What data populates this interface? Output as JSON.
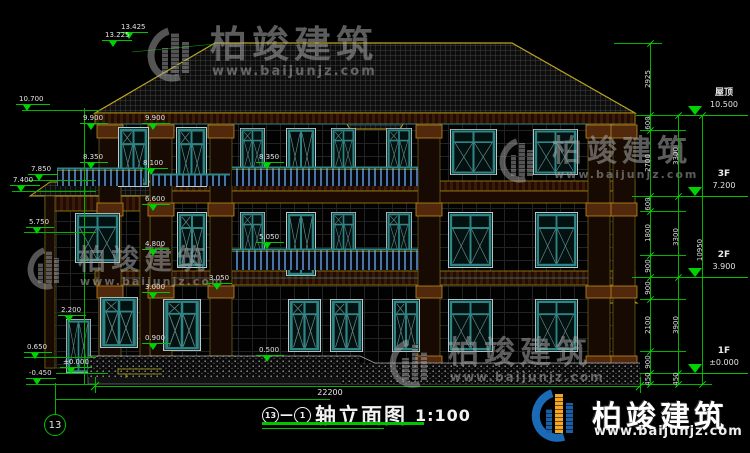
{
  "drawing_title": {
    "start_axis": "13",
    "end_axis": "1",
    "name": "轴立面图",
    "scale": "1:100"
  },
  "axis_bubble": {
    "label": "13"
  },
  "brand": {
    "name": "柏竣建筑",
    "url": "www.baijunjz.com"
  },
  "bottom_dimension": {
    "value": "22200"
  },
  "floor_levels": [
    {
      "name": "屋顶",
      "elevation": "10.500",
      "y": 115
    },
    {
      "name": "3F",
      "elevation": "7.200",
      "y": 196
    },
    {
      "name": "2F",
      "elevation": "3.900",
      "y": 277
    },
    {
      "name": "1F",
      "elevation": "±0.000",
      "y": 373
    }
  ],
  "level_markers": [
    {
      "value": "13.425",
      "x": 118,
      "y": 23,
      "lw": 30
    },
    {
      "value": "13.225",
      "x": 102,
      "y": 31,
      "lw": 30
    },
    {
      "value": "10.700",
      "x": 16,
      "y": 95,
      "lw": 34
    },
    {
      "value": "9.900",
      "x": 80,
      "y": 114,
      "lw": 28
    },
    {
      "value": "9.900",
      "x": 142,
      "y": 114,
      "lw": 28
    },
    {
      "value": "8.350",
      "x": 80,
      "y": 153,
      "lw": 28
    },
    {
      "value": "8.100",
      "x": 140,
      "y": 159,
      "lw": 28
    },
    {
      "value": "7.850",
      "x": 28,
      "y": 165,
      "lw": 30
    },
    {
      "value": "7.400",
      "x": 10,
      "y": 176,
      "lw": 30
    },
    {
      "value": "8.350",
      "x": 256,
      "y": 153,
      "lw": 28
    },
    {
      "value": "6.600",
      "x": 142,
      "y": 195,
      "lw": 28
    },
    {
      "value": "5.750",
      "x": 26,
      "y": 218,
      "lw": 28
    },
    {
      "value": "5.050",
      "x": 256,
      "y": 233,
      "lw": 28
    },
    {
      "value": "4.800",
      "x": 142,
      "y": 240,
      "lw": 28
    },
    {
      "value": "3.050",
      "x": 206,
      "y": 274,
      "lw": 26
    },
    {
      "value": "3.000",
      "x": 142,
      "y": 283,
      "lw": 28
    },
    {
      "value": "2.200",
      "x": 58,
      "y": 306,
      "lw": 28
    },
    {
      "value": "0.900",
      "x": 142,
      "y": 334,
      "lw": 28
    },
    {
      "value": "0.650",
      "x": 24,
      "y": 343,
      "lw": 28
    },
    {
      "value": "0.500",
      "x": 256,
      "y": 346,
      "lw": 28
    },
    {
      "value": "±0.000",
      "x": 60,
      "y": 358,
      "lw": 32
    },
    {
      "value": "-0.450",
      "x": 26,
      "y": 369,
      "lw": 30
    }
  ],
  "right_dimension_chains": [
    {
      "x": 650,
      "ticks": [
        43,
        115,
        130,
        196,
        211,
        255,
        277,
        299,
        351,
        373,
        384
      ],
      "values": [
        "2925",
        "600",
        "2700",
        "600",
        "1800",
        "900",
        "900",
        "2100",
        "900",
        "450"
      ]
    },
    {
      "x": 678,
      "ticks": [
        115,
        196,
        277,
        373,
        384
      ],
      "values": [
        "3300",
        "3300",
        "3900",
        "450"
      ]
    },
    {
      "x": 702,
      "ticks": [
        115,
        384
      ],
      "values": [
        "10950"
      ]
    }
  ]
}
